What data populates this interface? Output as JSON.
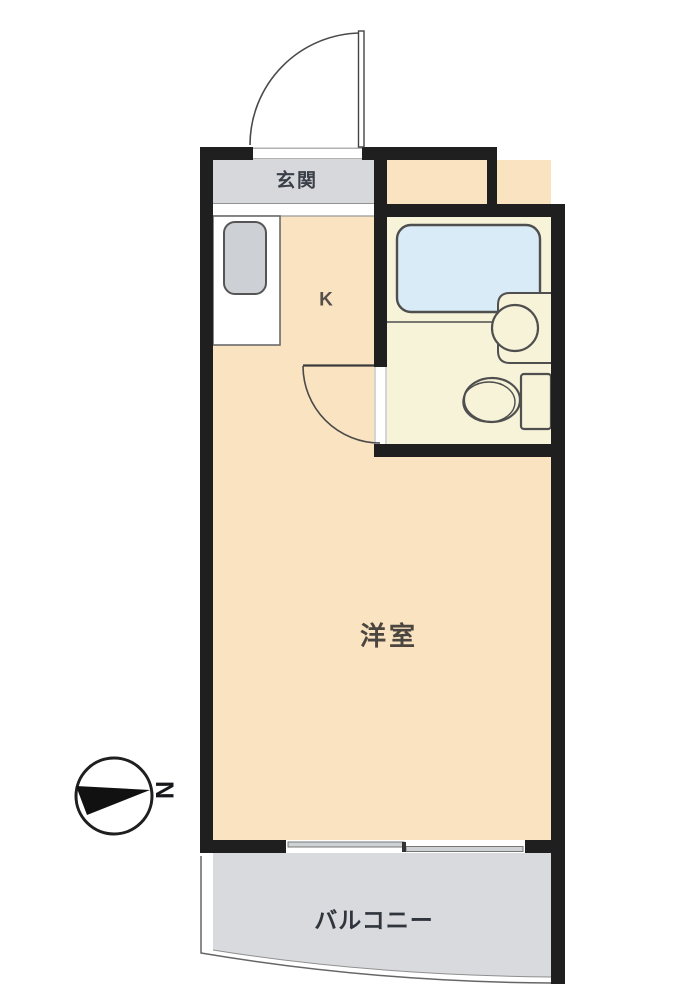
{
  "plan": {
    "type": "apartment-floor-plan",
    "rooms": {
      "genkan": {
        "label": "玄関"
      },
      "kitchen": {
        "label": "K"
      },
      "western_room": {
        "label": "洋室"
      },
      "balcony": {
        "label": "バルコニー"
      }
    },
    "compass": {
      "north_label": "N"
    }
  },
  "colors": {
    "wall": "#1f1f1f",
    "room_floor": "#fae3c1",
    "genkan_floor": "#d6d8db",
    "balcony_floor": "#d8dadd",
    "bathroom_floor": "#f7f3d8",
    "bathtub": "#d8ebf7",
    "sink": "#cdd0d4",
    "fixture_outline": "#4f4f4f",
    "window_pane": "#cfd2d5"
  }
}
